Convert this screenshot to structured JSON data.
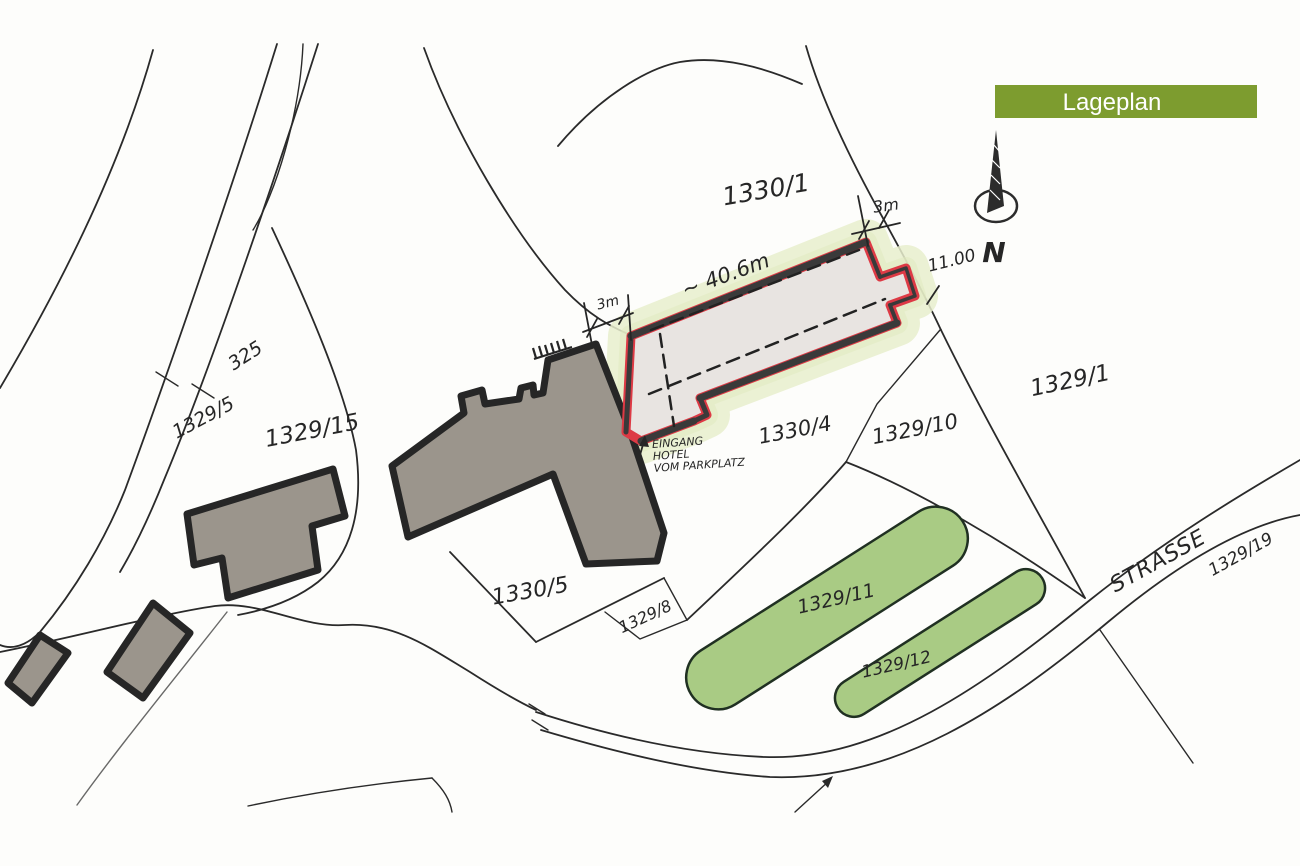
{
  "title": {
    "label": "Lageplan"
  },
  "north": {
    "label": "N"
  },
  "street": {
    "label": "STRASSE"
  },
  "parcels": {
    "p1330_1": "1330/1",
    "p1329_1": "1329/1",
    "p325": "325",
    "p1329_5": "1329/5",
    "p1329_15": "1329/15",
    "p1330_4": "1330/4",
    "p1329_10": "1329/10",
    "p1330_5": "1330/5",
    "p1329_8": "1329/8",
    "p1329_11": "1329/11",
    "p1329_12": "1329/12",
    "p1329_19": "1329/19"
  },
  "dimensions": {
    "top_offset": "3m",
    "left_offset": "3m",
    "building_width": "11.00",
    "building_length": "~ 40.6m"
  },
  "entrance_note": {
    "line1": "EINGANG",
    "line2": "HOTEL",
    "line3": "VOM PARKPLATZ"
  },
  "colors": {
    "paper": "#fdfdfb",
    "ink": "#262626",
    "line": "#2a2a2a",
    "title_bg": "#7d9c2f",
    "title_text": "#ffffff",
    "red": "#dd3a45",
    "building_fill": "#9b958c",
    "plan_fill": "#e8e4e1",
    "green_strip": "#a9cb84",
    "green_glow": "#e9efce"
  }
}
